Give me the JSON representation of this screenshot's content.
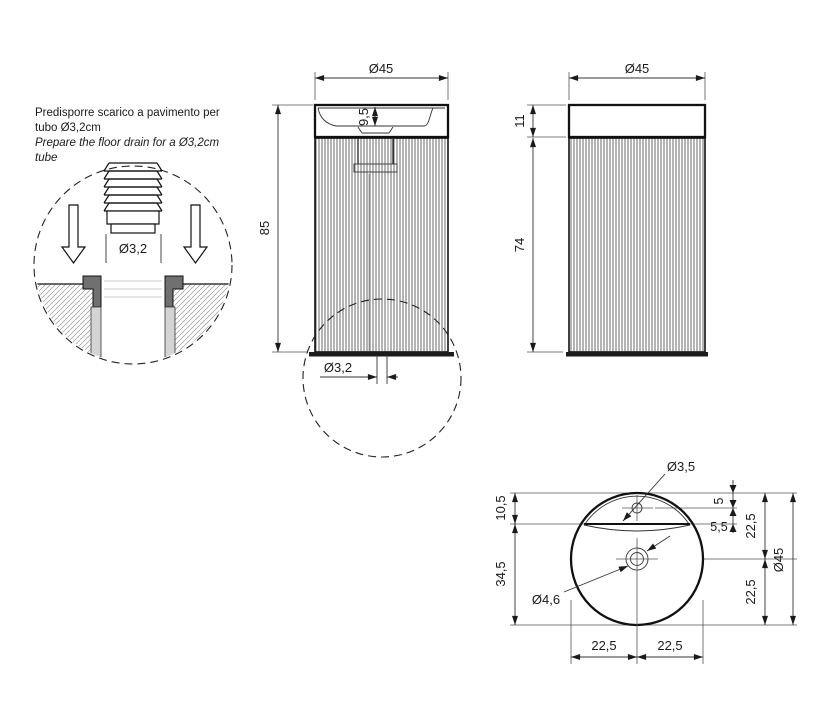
{
  "page": {
    "background": "#ffffff",
    "line_color": "#1a1a1a",
    "accent_gray": "#707070"
  },
  "note": {
    "line1": "Predisporre scarico a pavimento per",
    "line2": "tubo Ø3,2cm",
    "line3": "Prepare the floor drain for a Ø3,2cm",
    "line4": "tube"
  },
  "detail_view": {
    "drain_pipe_dia": "Ø3,2"
  },
  "front_view": {
    "width_dia": "Ø45",
    "height": "85",
    "basin_depth": "9,5",
    "floor_drain_dia": "Ø3,2"
  },
  "side_view": {
    "width_dia": "Ø45",
    "rim_height": "11",
    "pedestal_height": "74"
  },
  "top_view": {
    "tap_hole_dia": "Ø3,5",
    "drain_hole_dia": "Ø4,6",
    "rim_to_slot": "10,5",
    "slot_to_bottom": "34,5",
    "edge_to_tap": "5",
    "tap_to_slot": "5,5",
    "radius_upper": "22,5",
    "radius_lower": "22,5",
    "outer_dia": "Ø45",
    "half_left": "22,5",
    "half_right": "22,5"
  }
}
